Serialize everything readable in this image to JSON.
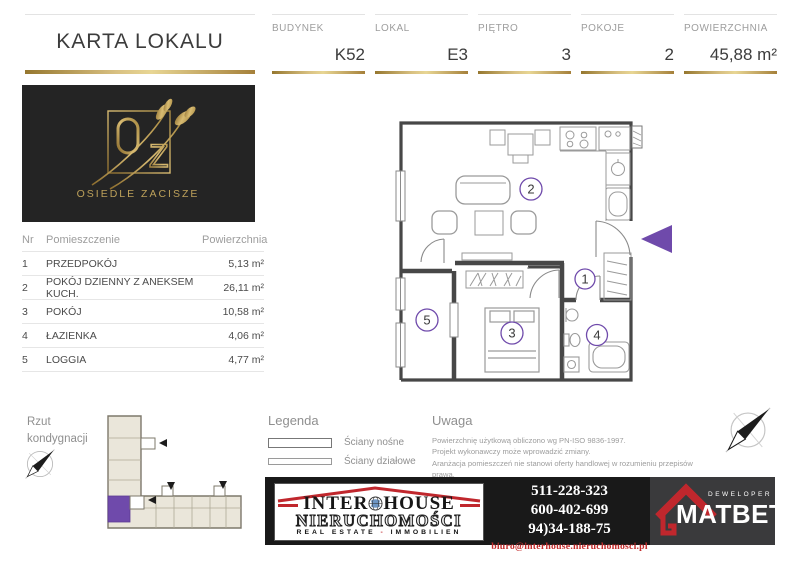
{
  "header": {
    "title": "KARTA LOKALU",
    "fields": [
      {
        "label": "BUDYNEK",
        "value": "K52"
      },
      {
        "label": "LOKAL",
        "value": "E3"
      },
      {
        "label": "PIĘTRO",
        "value": "3"
      },
      {
        "label": "POKOJE",
        "value": "2"
      },
      {
        "label": "POWIERZCHNIA",
        "value": "45,88 m²"
      }
    ]
  },
  "estate_logo": {
    "letter_o": "O",
    "letter_z": "Z",
    "name": "OSIEDLE ZACISZE"
  },
  "rooms_table": {
    "headers": {
      "nr": "Nr",
      "name": "Pomieszczenie",
      "area": "Powierzchnia"
    },
    "rows": [
      {
        "nr": "1",
        "name": "PRZEDPOKÓJ",
        "area": "5,13 m²"
      },
      {
        "nr": "2",
        "name": "POKÓJ DZIENNY Z ANEKSEM KUCH.",
        "area": "26,11 m²"
      },
      {
        "nr": "3",
        "name": "POKÓJ",
        "area": "10,58 m²"
      },
      {
        "nr": "4",
        "name": "ŁAZIENKA",
        "area": "4,06 m²"
      },
      {
        "nr": "5",
        "name": "LOGGIA",
        "area": "4,77 m²"
      }
    ]
  },
  "floor_plan": {
    "room_numbers": [
      "1",
      "2",
      "3",
      "4",
      "5"
    ]
  },
  "site_plan": {
    "title_line1": "Rzut",
    "title_line2": "kondygnacji"
  },
  "legend": {
    "title": "Legenda",
    "items": [
      {
        "label": "Ściany nośne"
      },
      {
        "label": "Ściany działowe"
      }
    ]
  },
  "notice": {
    "title": "Uwaga",
    "lines": [
      "Powierzchnię użytkową obliczono wg PN-ISO 9836-1997.",
      "Projekt wykonawczy może wprowadzić zmiany.",
      "Aranżacja pomieszczeń nie stanowi oferty handlowej w rozumieniu przepisów prawa,",
      "ma jedynie charakter poglądowy."
    ]
  },
  "footer": {
    "agency": {
      "name_left": "INTER",
      "name_right": "HOUSE",
      "subtitle": "NIERUCHOMOŚCI",
      "tagline_left": "REAL ESTATE",
      "tagline_dash": " - ",
      "tagline_right": "IMMOBILIEN"
    },
    "phones": [
      "511-228-323",
      "600-402-699",
      "94)34-188-75"
    ],
    "email": "biuro@interhouse.nieruchomosci.pl",
    "developer": {
      "label": "DEWELOPER",
      "name": "MATBET"
    }
  },
  "colors": {
    "gold": "#c3a45c",
    "purple": "#6f4aab",
    "red": "#c0272d"
  }
}
